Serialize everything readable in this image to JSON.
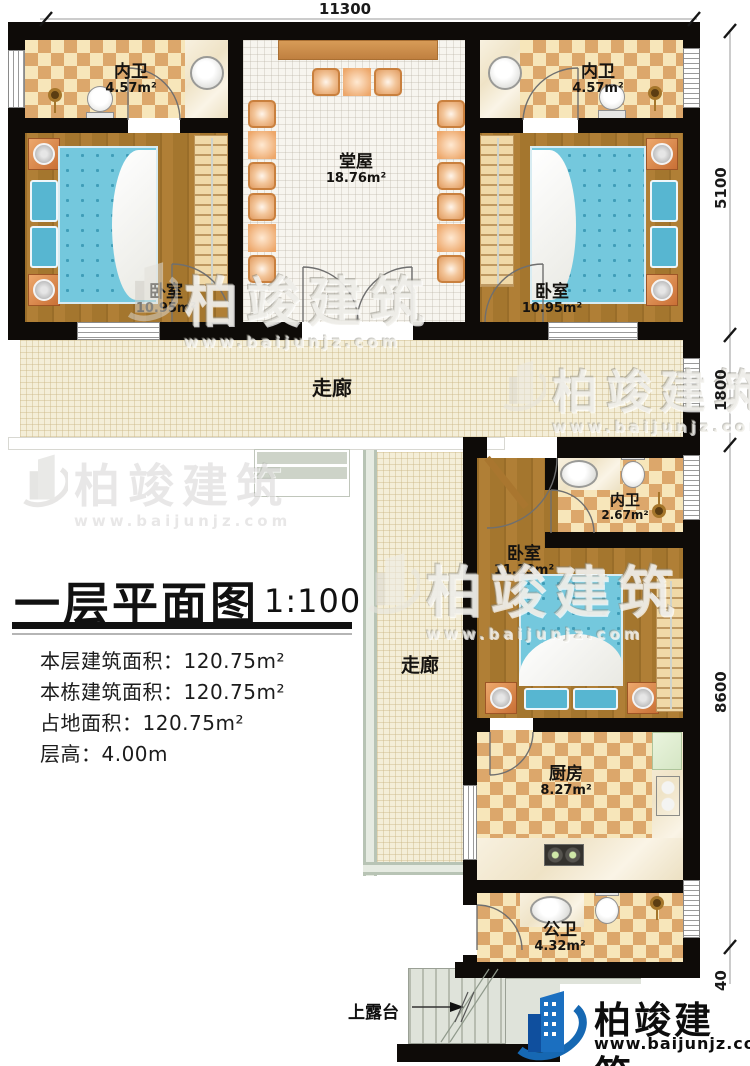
{
  "dimensions": {
    "top": "11300",
    "right_5100": "5100",
    "right_1800": "1800",
    "right_8600": "8600",
    "right_40": "40"
  },
  "rooms": {
    "bath_top_left": {
      "name": "内卫",
      "area": "4.57m²"
    },
    "bath_top_right": {
      "name": "内卫",
      "area": "4.57m²"
    },
    "bedroom_top_left": {
      "name": "卧室",
      "area": "10.95m²"
    },
    "bedroom_top_right": {
      "name": "卧室",
      "area": "10.95m²"
    },
    "hall": {
      "name": "堂屋",
      "area": "18.76m²"
    },
    "corridor_horizontal": {
      "name": "走廊"
    },
    "corridor_vertical": {
      "name": "走廊"
    },
    "bath_middle": {
      "name": "内卫",
      "area": "2.67m²"
    },
    "bedroom_middle": {
      "name": "卧室",
      "area": "11.13m²"
    },
    "kitchen": {
      "name": "厨房",
      "area": "8.27m²"
    },
    "bath_public": {
      "name": "公卫",
      "area": "4.32m²"
    },
    "terrace": {
      "label": "上露台"
    }
  },
  "title_block": {
    "title": "一层平面图",
    "scale": "1:100",
    "lines": [
      "本层建筑面积：120.75m²",
      "本栋建筑面积：120.75m²",
      "占地面积：120.75m²",
      "层高：4.00m"
    ]
  },
  "watermark": {
    "brand": "柏竣建筑",
    "url": "www.baijunjz.com"
  },
  "logo": {
    "brand": "柏竣建筑",
    "url": "www.baijunjz.com"
  },
  "colors": {
    "wall": "#0e0b08",
    "tile_dark": "#dca76b",
    "tile_light": "#f7e6ba",
    "wood": "#a9762f",
    "bed_blue": "#74c8dd",
    "brand_blue": "#1668b3"
  }
}
